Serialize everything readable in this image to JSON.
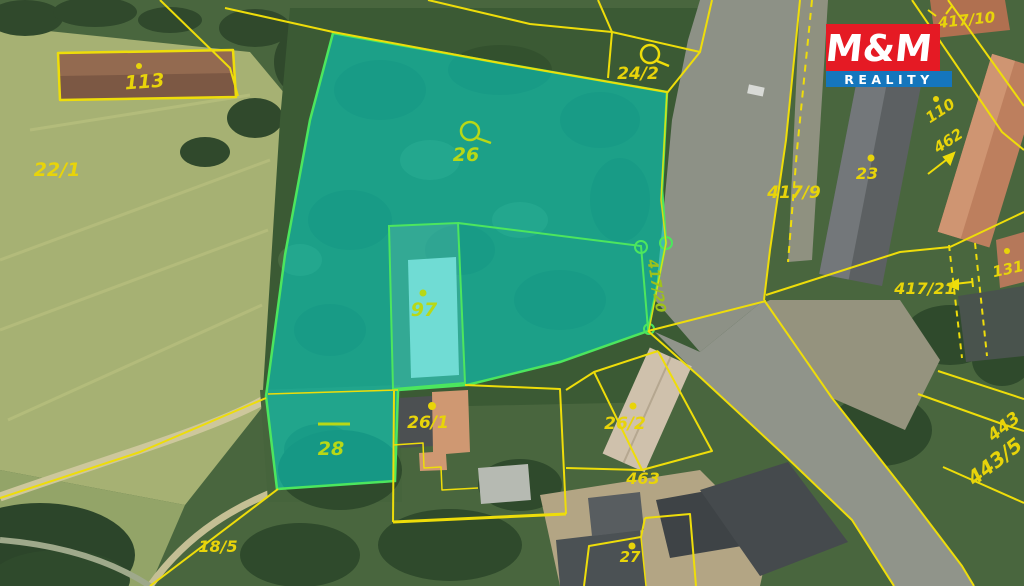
{
  "map": {
    "type": "cadastral-aerial-map",
    "highlighted_parcels": [
      "26",
      "97",
      "28",
      "417/20"
    ]
  },
  "colors": {
    "boundary_yellow": "#eedd0a",
    "label_yellow": "#e8d40a",
    "highlight_fill": "rgba(0,225,215,0.52)",
    "highlight_stroke": "#4ce65e",
    "highlight_label_green": "#b8d816",
    "logo_red": "#e51a24",
    "logo_blue": "#1576bd"
  },
  "logo": {
    "mm": "M&M",
    "reality": "REALITY"
  },
  "labels": {
    "p113": "113",
    "p22_1": "22/1",
    "p26": "26",
    "p24_2": "24/2",
    "p417_10": "417/10",
    "p417_9": "417/9",
    "p23": "23",
    "p110": "110",
    "p462": "462",
    "p417_21": "417/21",
    "p131": "131",
    "p417_20": "417/20",
    "p97": "97",
    "p28": "28",
    "p26_1": "26/1",
    "p26_2": "26/2",
    "p463": "463",
    "p18_5": "18/5",
    "p27": "27",
    "p443": "443",
    "p443_5": "443/5"
  }
}
